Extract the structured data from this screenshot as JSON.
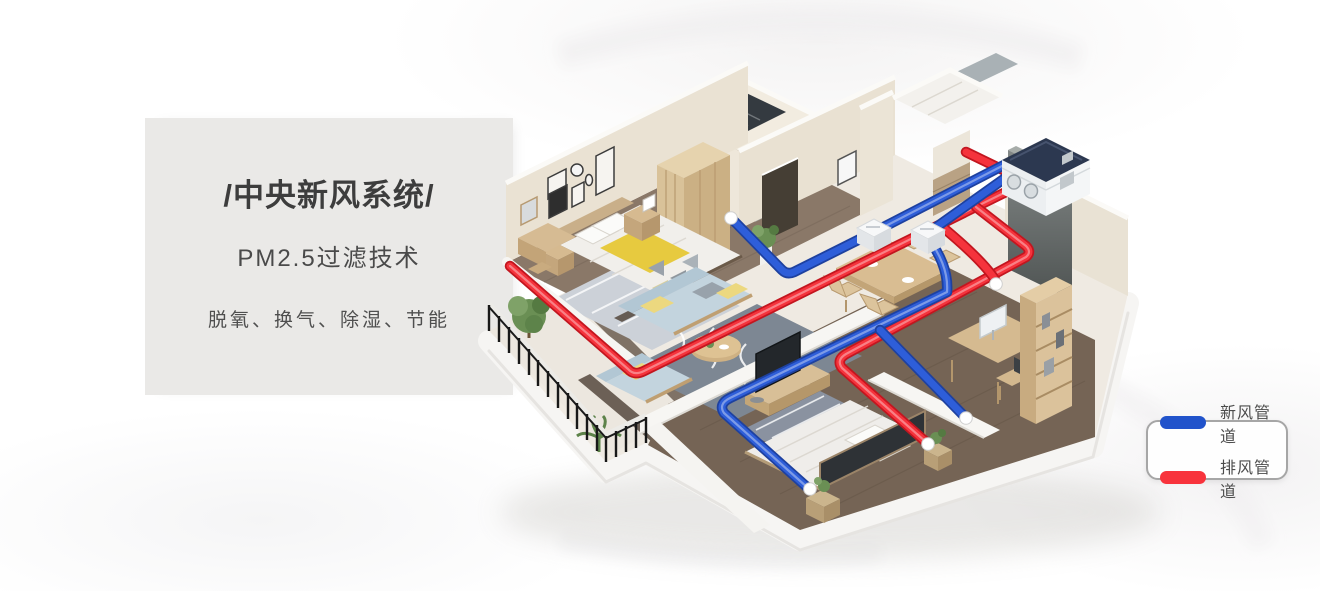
{
  "panel": {
    "title": "/中央新风系统/",
    "subtitle": "PM2.5过滤技术",
    "features": "脱氧、换气、除湿、节能"
  },
  "legend": {
    "items": [
      {
        "label": "新风管道",
        "color": "#2153cb"
      },
      {
        "label": "排风管道",
        "color": "#f8333c"
      }
    ]
  },
  "colors": {
    "fresh_air_pipe": "#2e5ed9",
    "exhaust_pipe": "#f5333c"
  }
}
